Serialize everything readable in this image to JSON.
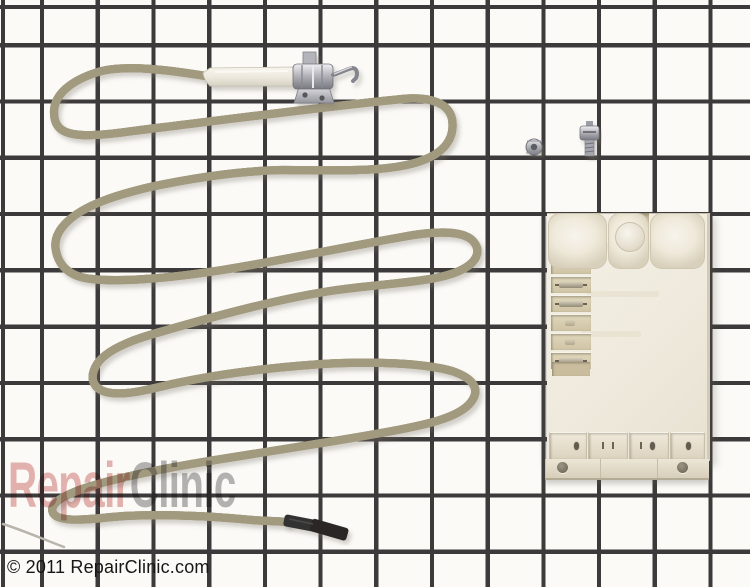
{
  "photo": {
    "watermark": {
      "part1": "Repair",
      "part2": "Clinic"
    },
    "footer": {
      "copyright": "© 2011 RepairClinic.com"
    },
    "parts": {
      "cable": "igniter wire cable",
      "electrode": "spark electrode with ceramic insulator and bracket",
      "module": "spark module",
      "hardware": "mounting nut and screw",
      "boot": "black terminal boot"
    },
    "colors": {
      "background": "#fbfaf7",
      "grid_line": "#3c3a3b",
      "cable": "#e7e2cb",
      "cable_edge": "#a69d82",
      "ceramic": "#f4f1ea",
      "metal": "#b9b9bd",
      "module_body": "#f1ece1",
      "module_slot": "#d5caab",
      "boot_black": "#2d2b2a",
      "watermark_red": "#c44e4a",
      "watermark_gray": "#464648",
      "footer_text": "#161616"
    }
  }
}
